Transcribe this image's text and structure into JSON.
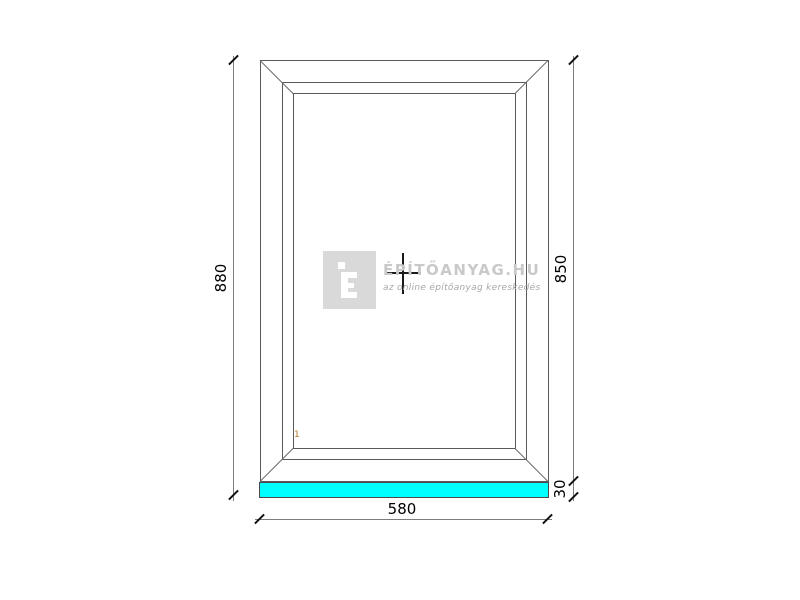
{
  "product_drawing": {
    "description": "fixed window technical drawing, front view",
    "type_marker_icon": "fixed-glazing-cross",
    "pane_label": "1",
    "dimensions": {
      "total_height_mm": "880",
      "frame_height_mm": "850",
      "sill_height_mm": "30",
      "width_mm": "580"
    },
    "colors": {
      "sill_fill": "#00ffff",
      "frame_line": "#5a5a5a",
      "dimension_line": "#7d7d7d",
      "dimension_text": "#000000",
      "pane_label": "#b97a2e",
      "watermark_title": "#c9c9c9",
      "watermark_logo_bg": "#d9d9d9"
    }
  },
  "watermark": {
    "logo_letter": "É",
    "title": "ÉPÍTŐANYAG.HU",
    "subtitle": "az online építőanyag kereskedés"
  }
}
